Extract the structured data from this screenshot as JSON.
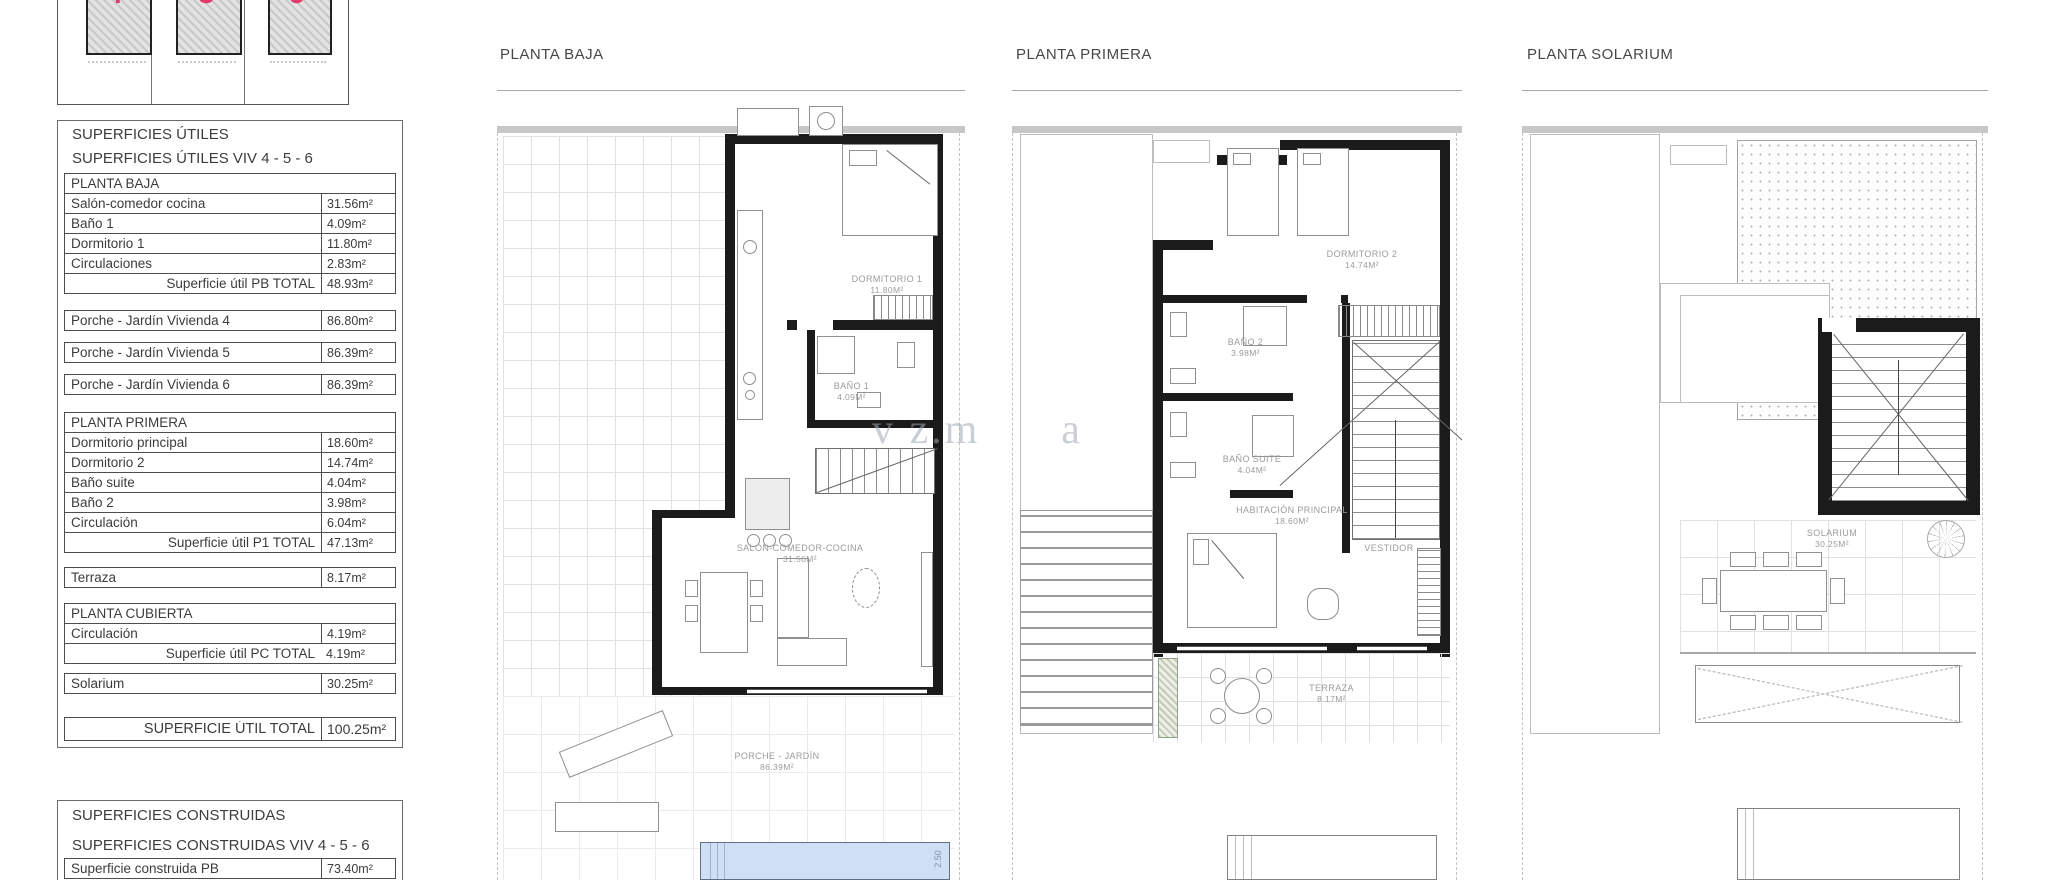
{
  "key_plan": {
    "units": [
      {
        "number": "4"
      },
      {
        "number": "5"
      },
      {
        "number": "6"
      }
    ],
    "accent_color": "#e23a6d"
  },
  "surfaces_utiles": {
    "title": "SUPERFICIES ÚTILES",
    "subtitle": "SUPERFICIES ÚTILES VIV 4 - 5 - 6",
    "pb_header": "PLANTA BAJA",
    "pb_rows": [
      {
        "label": "Salón-comedor cocina",
        "value": "31.56m²"
      },
      {
        "label": "Baño 1",
        "value": "4.09m²"
      },
      {
        "label": "Dormitorio 1",
        "value": "11.80m²"
      },
      {
        "label": "Circulaciones",
        "value": "2.83m²"
      }
    ],
    "pb_total": {
      "label": "Superficie útil PB TOTAL",
      "value": "48.93m²"
    },
    "porche_rows": [
      {
        "label": "Porche - Jardín Vivienda 4",
        "value": "86.80m²"
      },
      {
        "label": "Porche - Jardín Vivienda 5",
        "value": "86.39m²"
      },
      {
        "label": "Porche - Jardín Vivienda 6",
        "value": "86.39m²"
      }
    ],
    "p1_header": "PLANTA PRIMERA",
    "p1_rows": [
      {
        "label": "Dormitorio principal",
        "value": "18.60m²"
      },
      {
        "label": "Dormitorio 2",
        "value": "14.74m²"
      },
      {
        "label": "Baño suite",
        "value": "4.04m²"
      },
      {
        "label": "Baño 2",
        "value": "3.98m²"
      },
      {
        "label": "Circulación",
        "value": "6.04m²"
      }
    ],
    "p1_total": {
      "label": "Superficie útil P1 TOTAL",
      "value": "47.13m²"
    },
    "terraza": {
      "label": "Terraza",
      "value": "8.17m²"
    },
    "pc_header": "PLANTA CUBIERTA",
    "pc_rows": [
      {
        "label": "Circulación",
        "value": "4.19m²"
      }
    ],
    "pc_total": {
      "label": "Superficie útil PC TOTAL",
      "value": "4.19m²"
    },
    "solarium_row": {
      "label": "Solarium",
      "value": "30.25m²"
    },
    "grand_total": {
      "label": "SUPERFICIE ÚTIL TOTAL",
      "value": "100.25m²"
    }
  },
  "surfaces_construidas": {
    "title": "SUPERFICIES CONSTRUIDAS",
    "subtitle": "SUPERFICIES CONSTRUIDAS VIV 4 - 5 - 6",
    "rows": [
      {
        "label": "Superficie construida PB",
        "value": "73.40m²"
      }
    ]
  },
  "plans": {
    "baja": {
      "title": "PLANTA BAJA",
      "rooms": {
        "dormitorio1": {
          "name": "DORMITORIO 1",
          "area": "11.80m²"
        },
        "bano1": {
          "name": "BAÑO 1",
          "area": "4.09m²"
        },
        "salon": {
          "name": "SALÓN-COMEDOR-COCINA",
          "area": "31.56m²"
        },
        "porche": {
          "name": "PORCHE - JARDÍN",
          "area": "86.39m²"
        }
      },
      "pool_dim": "2.50"
    },
    "primera": {
      "title": "PLANTA PRIMERA",
      "rooms": {
        "dormitorio2": {
          "name": "DORMITORIO 2",
          "area": "14.74m²"
        },
        "bano2": {
          "name": "BAÑO 2",
          "area": "3.98m²"
        },
        "banosuite": {
          "name": "BAÑO SUITE",
          "area": "4.04m²"
        },
        "habitacion": {
          "name": "HABITACIÓN PRINCIPAL",
          "area": "18.60m²"
        },
        "vestidor": {
          "name": "VESTIDOR"
        },
        "terraza": {
          "name": "TERRAZA",
          "area": "8.17m²"
        }
      }
    },
    "solarium": {
      "title": "PLANTA SOLARIUM",
      "rooms": {
        "solarium": {
          "name": "SOLARIUM",
          "area": "30.25m²"
        }
      }
    }
  },
  "watermark": "v z.m      a"
}
